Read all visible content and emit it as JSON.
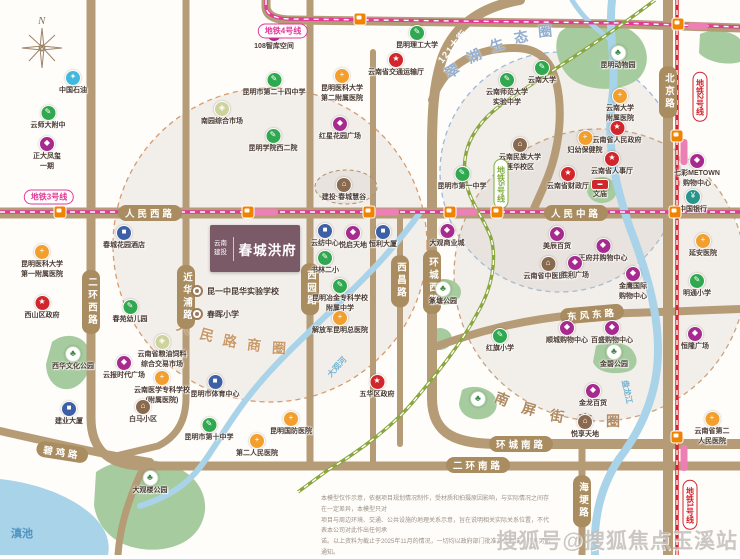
{
  "map": {
    "compass_label": "N",
    "watermark": "搜狐号@搜狐焦点玉溪站"
  },
  "project": {
    "developer": "云南建投",
    "name": "春城洪府"
  },
  "bullets": [
    {
      "x": 191,
      "y": 291,
      "label": "昆一中昆华实验学校"
    },
    {
      "x": 191,
      "y": 314,
      "label": "春晖小学"
    }
  ],
  "business_circles": [
    {
      "name": "人民路商圈",
      "color": "#c99a6a",
      "chars": [
        {
          "c": "人",
          "x": 184,
          "y": 327,
          "r": 20
        },
        {
          "c": "民",
          "x": 207,
          "y": 335,
          "r": 16
        },
        {
          "c": "路",
          "x": 230,
          "y": 341,
          "r": 11
        },
        {
          "c": "商",
          "x": 254,
          "y": 345,
          "r": 7
        },
        {
          "c": "圈",
          "x": 279,
          "y": 348,
          "r": 3
        }
      ]
    },
    {
      "name": "翠湖生态圈",
      "color": "#93aed0",
      "chars": [
        {
          "c": "翠",
          "x": 452,
          "y": 71,
          "r": -32
        },
        {
          "c": "湖",
          "x": 474,
          "y": 56,
          "r": -26
        },
        {
          "c": "生",
          "x": 497,
          "y": 45,
          "r": -19
        },
        {
          "c": "态",
          "x": 521,
          "y": 37,
          "r": -11
        },
        {
          "c": "圈",
          "x": 545,
          "y": 31,
          "r": -5
        }
      ]
    },
    {
      "name": "南屏街商圈",
      "color": "#b08b62",
      "chars": [
        {
          "c": "南",
          "x": 502,
          "y": 399,
          "r": 22
        },
        {
          "c": "屏",
          "x": 529,
          "y": 409,
          "r": 16
        },
        {
          "c": "街",
          "x": 557,
          "y": 416,
          "r": 10
        },
        {
          "c": "商",
          "x": 585,
          "y": 420,
          "r": 4
        },
        {
          "c": "圈",
          "x": 613,
          "y": 421,
          "r": 0
        }
      ]
    }
  ],
  "roads": {
    "labels": [
      {
        "text": "人民西路",
        "x": 150,
        "y": 213,
        "o": "h",
        "rot": 0
      },
      {
        "text": "人民中路",
        "x": 576,
        "y": 213,
        "o": "h",
        "rot": 0
      },
      {
        "text": "二环西路",
        "x": 91,
        "y": 302,
        "o": "v",
        "rot": 0
      },
      {
        "text": "近华浦路",
        "x": 186,
        "y": 297,
        "o": "v",
        "rot": 0
      },
      {
        "text": "西园路",
        "x": 310,
        "y": 289,
        "o": "v",
        "rot": 0
      },
      {
        "text": "西昌路",
        "x": 400,
        "y": 281,
        "o": "v",
        "rot": 0
      },
      {
        "text": "环城西路",
        "x": 432,
        "y": 282,
        "o": "v",
        "rot": 0
      },
      {
        "text": "北京路",
        "x": 668,
        "y": 92,
        "o": "v",
        "rot": 0
      },
      {
        "text": "东风东路",
        "x": 592,
        "y": 314,
        "o": "h",
        "rot": -5
      },
      {
        "text": "环城南路",
        "x": 521,
        "y": 444,
        "o": "h",
        "rot": 0
      },
      {
        "text": "二环南路",
        "x": 478,
        "y": 465,
        "o": "h",
        "rot": 0
      },
      {
        "text": "碧鸡路",
        "x": 62,
        "y": 452,
        "o": "h",
        "rot": 9
      },
      {
        "text": "海埂路",
        "x": 582,
        "y": 501,
        "o": "v",
        "rot": 0
      }
    ],
    "plain_label": {
      "text": "121大街",
      "x": 452,
      "y": 46
    }
  },
  "metro": {
    "badges": [
      {
        "text": "地铁3号线",
        "x": 49,
        "y": 197,
        "c": "#e23a97",
        "o": "h"
      },
      {
        "text": "地铁4号线",
        "x": 283,
        "y": 31,
        "c": "#e23a97",
        "o": "h"
      },
      {
        "text": "地铁5号线",
        "x": 501,
        "y": 184,
        "c": "#7fae3f",
        "o": "v"
      },
      {
        "text": "地铁2号线",
        "x": 700,
        "y": 97,
        "c": "#d4232c",
        "o": "v"
      },
      {
        "text": "地铁1号线",
        "x": 690,
        "y": 505,
        "c": "#d4232c",
        "o": "v"
      }
    ],
    "stations": [
      [
        360,
        19
      ],
      [
        678,
        24
      ],
      [
        60,
        212
      ],
      [
        248,
        212
      ],
      [
        369,
        212
      ],
      [
        450,
        212
      ],
      [
        497,
        212
      ],
      [
        675,
        212
      ],
      [
        677,
        136
      ],
      [
        677,
        437
      ]
    ],
    "banners": [
      [
        265,
        212,
        26,
        7
      ],
      [
        386,
        212,
        26,
        7
      ],
      [
        466,
        212,
        24,
        7
      ],
      [
        684,
        152,
        7,
        26
      ],
      [
        684,
        458,
        7,
        26
      ],
      [
        698,
        26,
        20,
        7
      ]
    ]
  },
  "water_labels": [
    {
      "text": "滇池",
      "x": 22,
      "y": 533,
      "size": 11,
      "rot": 0,
      "color": "#4f93c0"
    },
    {
      "text": "大观河",
      "x": 337,
      "y": 367,
      "size": 8,
      "rot": -48,
      "color": "#74b4d4"
    },
    {
      "text": "盘龙江",
      "x": 627,
      "y": 392,
      "size": 8,
      "rot": 78,
      "color": "#74b4d4"
    }
  ],
  "pois": [
    {
      "x": 73,
      "y": 77,
      "t": "petro",
      "label": [
        "中国石油"
      ]
    },
    {
      "x": 48,
      "y": 112,
      "t": "school",
      "label": [
        "云师大附中"
      ]
    },
    {
      "x": 47,
      "y": 143,
      "t": "mall",
      "label": [
        "正大凤玺",
        "一期"
      ]
    },
    {
      "x": 274,
      "y": 33,
      "t": "mall",
      "label": [
        "108智库空间"
      ]
    },
    {
      "x": 274,
      "y": 79,
      "t": "school",
      "label": [
        "昆明市第二十四中学"
      ]
    },
    {
      "x": 222,
      "y": 108,
      "t": "market",
      "label": [
        "南园综合市场"
      ]
    },
    {
      "x": 273,
      "y": 135,
      "t": "school",
      "label": [
        "昆明学院西二院"
      ]
    },
    {
      "x": 342,
      "y": 75,
      "t": "hospital",
      "label": [
        "昆明医科大学",
        "第二附属医院"
      ]
    },
    {
      "x": 340,
      "y": 123,
      "t": "mall",
      "label": [
        "红星花园广场"
      ]
    },
    {
      "x": 417,
      "y": 32,
      "t": "school",
      "label": [
        "昆明理工大学"
      ]
    },
    {
      "x": 396,
      "y": 59,
      "t": "government",
      "label": [
        "云南省交通运输厅"
      ]
    },
    {
      "x": 507,
      "y": 79,
      "t": "school",
      "label": [
        "云南师范大学",
        "实验中学"
      ]
    },
    {
      "x": 542,
      "y": 67,
      "t": "school",
      "label": [
        "云南大学"
      ]
    },
    {
      "x": 618,
      "y": 52,
      "t": "tree",
      "label": [
        "昆明动物园"
      ]
    },
    {
      "x": 620,
      "y": 95,
      "t": "hospital",
      "label": [
        "云南大学",
        "附属医院"
      ]
    },
    {
      "x": 617,
      "y": 127,
      "t": "government",
      "label": [
        "云南省人民政府"
      ]
    },
    {
      "x": 585,
      "y": 137,
      "t": "hospital",
      "label": [
        "妇幼保健院"
      ]
    },
    {
      "x": 612,
      "y": 158,
      "t": "government",
      "label": [
        "云南省人事厅"
      ]
    },
    {
      "x": 568,
      "y": 173,
      "t": "government",
      "label": [
        "云南省财政厅"
      ]
    },
    {
      "x": 600,
      "y": 186,
      "t": "temple",
      "label": [
        "文庙"
      ]
    },
    {
      "x": 697,
      "y": 160,
      "t": "mall",
      "label": [
        "七彩METOWN",
        "购物中心"
      ]
    },
    {
      "x": 693,
      "y": 196,
      "t": "bank",
      "label": [
        "中国银行"
      ]
    },
    {
      "x": 703,
      "y": 240,
      "t": "hospital",
      "label": [
        "延安医院"
      ]
    },
    {
      "x": 462,
      "y": 173,
      "t": "school",
      "label": [
        "昆明市第一中学"
      ]
    },
    {
      "x": 520,
      "y": 144,
      "t": "residence",
      "label": [
        "云南民族大学",
        "莲华校区"
      ]
    },
    {
      "x": 325,
      "y": 230,
      "t": "office",
      "label": [
        "云纺中心"
      ]
    },
    {
      "x": 353,
      "y": 232,
      "t": "mall",
      "label": [
        "悦启天地"
      ]
    },
    {
      "x": 383,
      "y": 231,
      "t": "office",
      "label": [
        "恒利大厦"
      ]
    },
    {
      "x": 325,
      "y": 257,
      "t": "school",
      "label": [
        "书林二小"
      ]
    },
    {
      "x": 340,
      "y": 285,
      "t": "school",
      "label": [
        "昆明冶金专科学校",
        "附属中学"
      ]
    },
    {
      "x": 340,
      "y": 317,
      "t": "hospital",
      "label": [
        "解放军昆明总医院"
      ]
    },
    {
      "x": 124,
      "y": 232,
      "t": "office",
      "label": [
        "春城花园酒店"
      ]
    },
    {
      "x": 42,
      "y": 251,
      "t": "hospital",
      "label": [
        "昆明医科大学",
        "第一附属医院"
      ]
    },
    {
      "x": 42,
      "y": 302,
      "t": "government",
      "label": [
        "西山区政府"
      ]
    },
    {
      "x": 130,
      "y": 306,
      "t": "school",
      "label": [
        "春苑幼儿园"
      ]
    },
    {
      "x": 69,
      "y": 408,
      "t": "office",
      "label": [
        "建业大厦"
      ]
    },
    {
      "x": 124,
      "y": 362,
      "t": "mall",
      "label": [
        "云报时代广场"
      ]
    },
    {
      "x": 162,
      "y": 341,
      "t": "market",
      "label": [
        "云南省粮油饲料",
        "综合交易市场"
      ]
    },
    {
      "x": 162,
      "y": 377,
      "t": "hospital",
      "label": [
        "云南医学专科学校",
        "(附属医院)"
      ]
    },
    {
      "x": 143,
      "y": 406,
      "t": "residence",
      "label": [
        "白马小区"
      ]
    },
    {
      "x": 73,
      "y": 353,
      "t": "tree",
      "label": [
        "西华文化公园"
      ]
    },
    {
      "x": 150,
      "y": 477,
      "t": "tree",
      "label": [
        "大观楼公园"
      ]
    },
    {
      "x": 215,
      "y": 381,
      "t": "office",
      "label": [
        "昆明市体育中心"
      ]
    },
    {
      "x": 209,
      "y": 424,
      "t": "school",
      "label": [
        "昆明市第十中学"
      ]
    },
    {
      "x": 291,
      "y": 418,
      "t": "hospital",
      "label": [
        "昆明国防医院"
      ]
    },
    {
      "x": 257,
      "y": 440,
      "t": "hospital",
      "label": [
        "第二人民医院"
      ]
    },
    {
      "x": 377,
      "y": 381,
      "t": "government",
      "label": [
        "五华区政府"
      ]
    },
    {
      "x": 548,
      "y": 263,
      "t": "residence",
      "label": [
        "云南省中医医院"
      ]
    },
    {
      "x": 557,
      "y": 233,
      "t": "mall",
      "label": [
        "美辰百货"
      ]
    },
    {
      "x": 603,
      "y": 245,
      "t": "mall",
      "label": [
        "王府井购物中心"
      ]
    },
    {
      "x": 567,
      "y": 327,
      "t": "mall",
      "label": [
        "顺城购物中心"
      ]
    },
    {
      "x": 612,
      "y": 327,
      "t": "mall",
      "label": [
        "百盛购物中心"
      ]
    },
    {
      "x": 500,
      "y": 335,
      "t": "school",
      "label": [
        "红旗小学"
      ]
    },
    {
      "x": 575,
      "y": 262,
      "t": "mall",
      "label": [
        "胜利广场"
      ]
    },
    {
      "x": 633,
      "y": 273,
      "t": "mall",
      "label": [
        "金鹰国际",
        "购物中心"
      ]
    },
    {
      "x": 695,
      "y": 333,
      "t": "mall",
      "label": [
        "恒隆广场"
      ]
    },
    {
      "x": 697,
      "y": 280,
      "t": "school",
      "label": [
        "明通小学"
      ]
    },
    {
      "x": 614,
      "y": 351,
      "t": "tree",
      "label": [
        "金碧公园"
      ]
    },
    {
      "x": 593,
      "y": 390,
      "t": "mall",
      "label": [
        "金龙百货"
      ]
    },
    {
      "x": 585,
      "y": 421,
      "t": "residence",
      "label": [
        "悦享天地"
      ]
    },
    {
      "x": 712,
      "y": 418,
      "t": "hospital",
      "label": [
        "云南省第二",
        "人民医院"
      ]
    },
    {
      "x": 447,
      "y": 230,
      "t": "mall",
      "label": [
        "大观商业城"
      ]
    },
    {
      "x": 344,
      "y": 184,
      "t": "residence",
      "label": [
        "建投·春城慧谷"
      ]
    },
    {
      "x": 443,
      "y": 288,
      "t": "tree",
      "label": [
        "篆塘公园"
      ]
    },
    {
      "x": 478,
      "y": 398,
      "t": "tree",
      "label": []
    }
  ],
  "disclaimer": {
    "lines": [
      "本模型仅作示意，依据项目规划情况制作，受材质和拍摄原因影响，与实际情况之间存在一定差异，本模型只对",
      "项目与周边环境、交通、公共设施的地理关系示意，旨在说明相关实际关系位置，不代表本公司对此作出任何承",
      "诺。以上资料为截止于2025年11月的情况，一切均以政府部门批准文件为准，不再另行通知。"
    ]
  },
  "colors": {
    "road": "#b59c76",
    "water": "#a9d3e8",
    "park": "#a5cb9e",
    "school": "#2fa84f",
    "hospital": "#f29f2e",
    "government": "#d0262c",
    "mall": "#a72a8e",
    "office": "#3d5fa5",
    "bank": "#27958a",
    "residence": "#8a6a4f",
    "market": "#cdd39b",
    "petro": "#41b9dc",
    "temple": "#d0262c",
    "tree": "#ffffff",
    "station": "#f08300",
    "metro_pink": "#e23a97",
    "metro_red": "#d4232c",
    "metro_green": "#8aa63f"
  }
}
